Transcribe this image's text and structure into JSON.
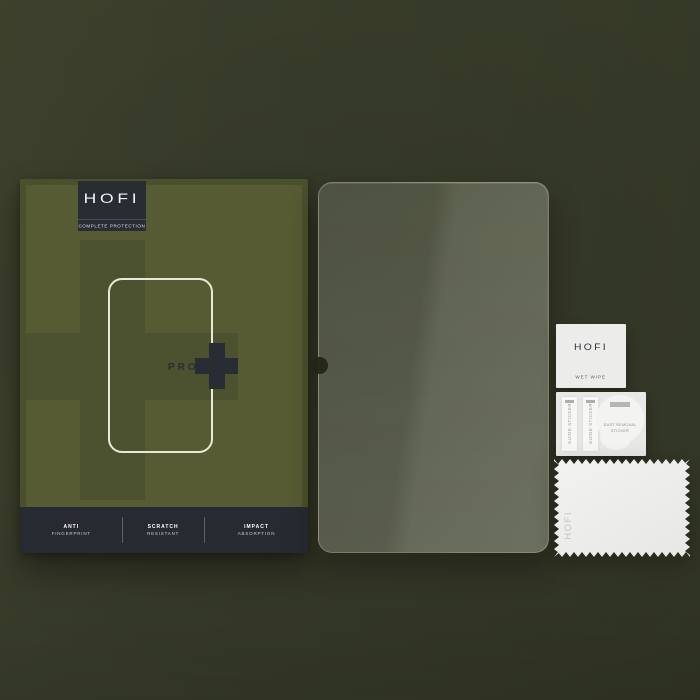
{
  "product_box": {
    "brand": "HOFI",
    "tagline": "COMPLETE PROTECTION",
    "model": "PRO",
    "plus_symbol": "+",
    "features": [
      {
        "title": "ANTI",
        "subtitle": "FINGERPRINT"
      },
      {
        "title": "SCRATCH",
        "subtitle": "RESISTANT"
      },
      {
        "title": "IMPACT",
        "subtitle": "ABSORPTION"
      }
    ]
  },
  "glass_protector": {
    "description": "transparent tempered glass tablet screen protector with camera notch on left edge"
  },
  "accessories": {
    "wet_wipe": {
      "brand": "HOFI",
      "label": "WET WIPE"
    },
    "guide_stickers": {
      "label": "GUIDE STICKER",
      "count": 2
    },
    "dust_removal_sticker": {
      "label_line1": "DUST REMOVAL",
      "label_line2": "STICKER"
    },
    "cleaning_cloth": {
      "brand": "HOFI"
    }
  },
  "colors": {
    "background_olive": "#383c29",
    "box_face": "#575b34",
    "box_cross": "#4c5130",
    "charcoal": "#282c33",
    "outline_cream": "#ebe8d5",
    "glass_tint": "#585c49",
    "accessory_white": "#ecedea"
  }
}
